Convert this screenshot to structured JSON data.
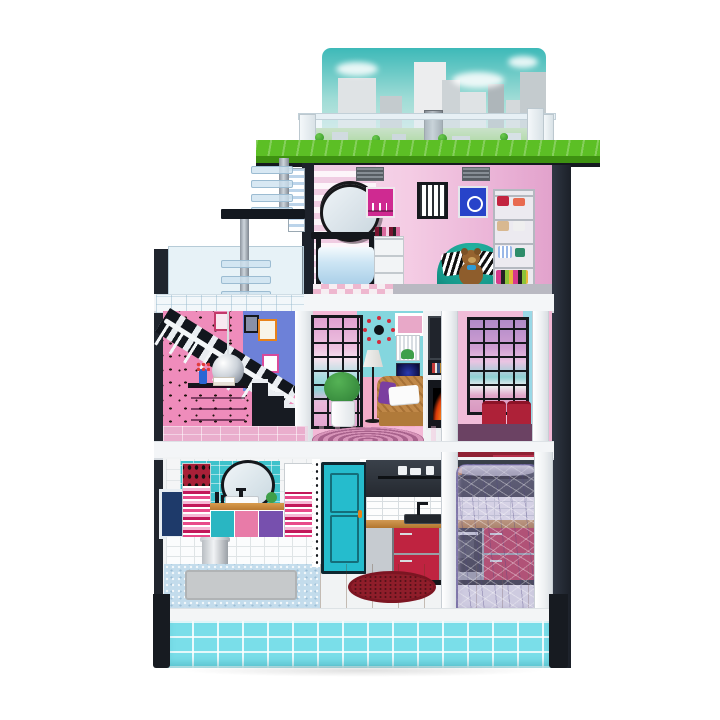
{
  "meta": {
    "type": "product-photo",
    "subject": "three-story wooden dollhouse with rooftop city terrace, open front, furnished rooms and translucent elevator pod",
    "background": "white studio backdrop"
  },
  "sections": {
    "rooftop": {
      "label": "Rooftop terrace with city skyline backdrop, clear railing and green lawn"
    },
    "dressing_room": {
      "label": "Top-floor dressing room with ornate vanity mirror, tulle-skirted vanity, teal tub chair with teddy bear and handbag shelf"
    },
    "balcony": {
      "label": "Left balcony with clear acrylic walls and ladder pole to the roof"
    },
    "stair_hall": {
      "label": "Second-floor stair hall with polka-dot pink wallpaper, black-and-white staircase, disco ball and magenta dresser"
    },
    "living_room": {
      "label": "Second-floor living room with tall window, floor lamp, potted plant, rattan armchair, starburst clock, TV and fireplace"
    },
    "window_nook": {
      "label": "Second-floor window nook with tall city window and two red ottomans"
    },
    "bathroom": {
      "label": "First-floor bathroom with teal tiles, round mirror, striped towels, tri-color vanity and mosaic floor"
    },
    "entry_door": {
      "label": "Teal paneled front door with orange handle"
    },
    "kitchen": {
      "label": "First-floor kitchen with dark upper wall, subway tile, wood counter, sink, red and gray cabinets and round red rug"
    },
    "elevator": {
      "label": "Translucent purple elevator pod"
    },
    "base": {
      "label": "Aqua tiled base platform with black corner feet"
    }
  },
  "palette": {
    "sky_top": "#3db9b8",
    "grass": "#5cbf25",
    "grass_edge": "#3e9111",
    "wall_black": "#1d222b",
    "stair_pink": "#ef8cbb",
    "wall_blue": "#6d81d8",
    "bath_teal": "#3ec2cb",
    "door_teal": "#25bccd",
    "base_cyan": "#7adee9",
    "kitchen_red": "#bf2340",
    "ottoman_red": "#ae2138",
    "teal_chair": "#16a394",
    "dresser_magenta": "#b52e92",
    "elevator_purple": "rgba(158,148,195,0.42)"
  }
}
